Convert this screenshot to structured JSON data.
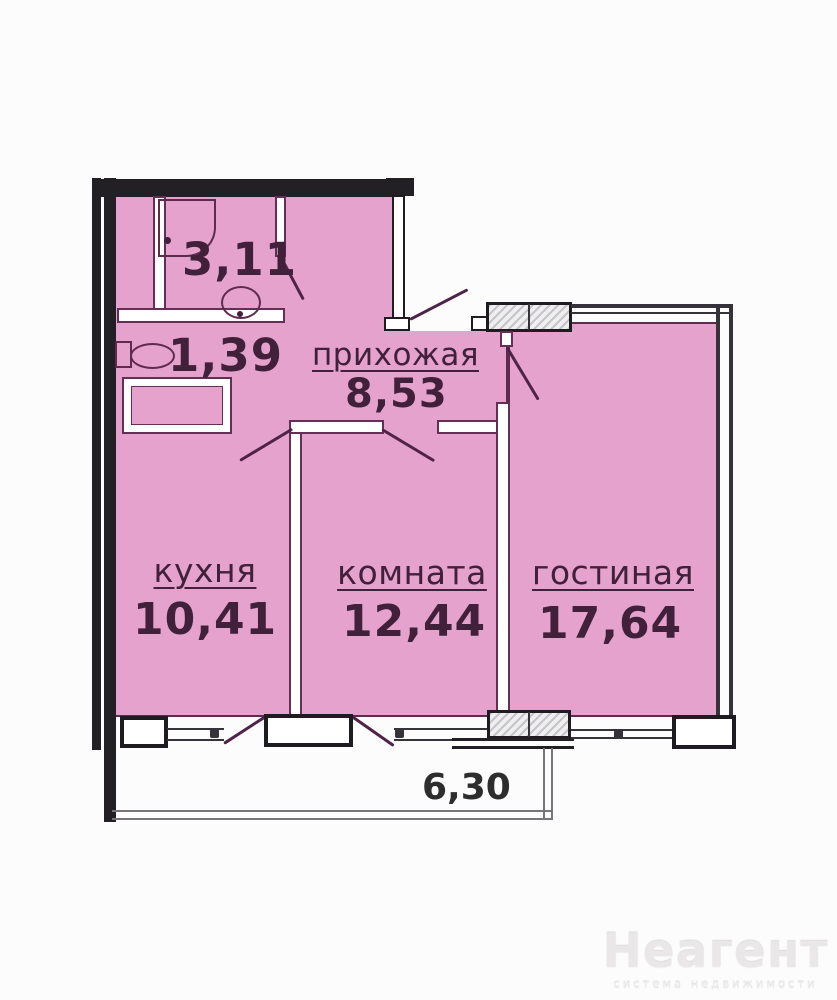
{
  "plan": {
    "rooms": [
      {
        "key": "bathroom",
        "name": "",
        "area": "3,11"
      },
      {
        "key": "toilet",
        "name": "",
        "area": "1,39"
      },
      {
        "key": "hallway",
        "name": "прихожая",
        "area": "8,53"
      },
      {
        "key": "kitchen",
        "name": "кухня",
        "area": "10,41"
      },
      {
        "key": "room",
        "name": "комната",
        "area": "12,44"
      },
      {
        "key": "living",
        "name": "гостиная",
        "area": "17,64"
      }
    ],
    "balcony": {
      "dimension": "6,30"
    },
    "fixtures": [
      "shower",
      "washbasin",
      "toilet-wc"
    ]
  },
  "watermark": {
    "brand": "Неагент",
    "tagline": "система недвижимости"
  },
  "colors": {
    "floor_fill": "#e5a2cd",
    "wall_outline": "#5e2b4f",
    "label_text": "#40203a",
    "exterior_wall": "#222024",
    "dimension_text": "#2d2d2d",
    "watermark_text": "#e9e7e8"
  }
}
